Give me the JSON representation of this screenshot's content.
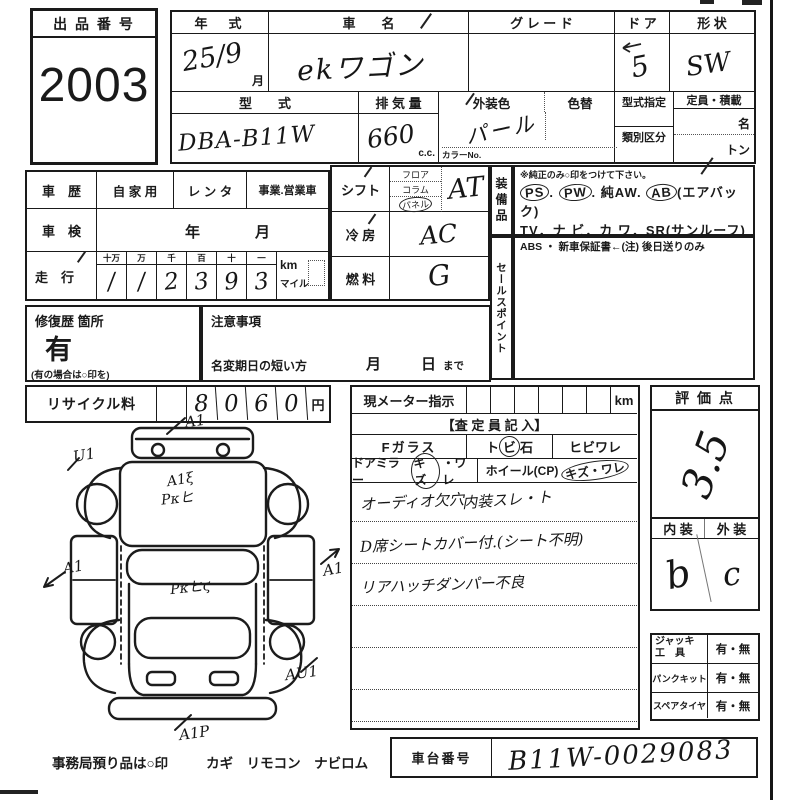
{
  "colors": {
    "ink": "#1a1a1a",
    "paper": "#ffffff"
  },
  "auction": {
    "label": "出 品 番 号",
    "number": "2003"
  },
  "vehicle": {
    "year_label": "年　式",
    "year_value": "25/9",
    "month_suffix": "月",
    "name_label": "車　　名",
    "name_value": "ekワゴン",
    "grade_label": "グ レ ー ド",
    "grade_value": "",
    "door_label": "ド ア",
    "door_value": "5",
    "shape_label": "形 状",
    "shape_value": "SW",
    "model_label": "型　　式",
    "model_value": "DBA-B11W",
    "disp_label": "排 気 量",
    "disp_value": "660",
    "disp_unit": "c.c.",
    "color_label": "外装色",
    "color_value": "パール",
    "color_change_label": "色替",
    "color_no_label": "カラーNo.",
    "type_desig_label": "型式指定",
    "class_label": "類別区分",
    "capacity_label": "定員・積載",
    "capacity_persons": "名",
    "capacity_tons": "トン"
  },
  "history": {
    "label": "車　歴",
    "private_label": "自 家 用",
    "rental_label": "レ ン タ",
    "business_label": "事業.営業車",
    "inspection_label": "車　検",
    "inspection_year": "年",
    "inspection_month": "月",
    "mileage_label": "走　行",
    "digit_headers": [
      "十万",
      "万",
      "千",
      "百",
      "十",
      "一"
    ],
    "digits": [
      "/",
      "/",
      "2",
      "3",
      "9",
      "3"
    ],
    "unit_km": "km",
    "unit_mile": "マイル"
  },
  "controls": {
    "shift_label": "シフト",
    "shift_opt1": "フロア",
    "shift_opt2": "コラム",
    "shift_opt3": "パネル",
    "shift_value": "AT",
    "ac_label": "冷 房",
    "ac_value": "AC",
    "fuel_label": "燃 料",
    "fuel_value": "G"
  },
  "equipment": {
    "vertical_label": "装備品",
    "note": "※純正のみ○印をつけて下さい。",
    "ps": "PS",
    "pw": "PW",
    "sep": ".",
    "aw": "純AW.",
    "ab": "AB",
    "ab_paren": "(エアバック)",
    "line2": "TV．ナ ビ．カ ワ．SR(サンルーフ)",
    "line3": "ABS ・ 新車保証書←(注) 後日送りのみ"
  },
  "sales_point": {
    "vertical_label": "セールスポイント"
  },
  "repair": {
    "label": "修復歴 箇所",
    "value": "有",
    "note": "(有の場合は○印を)"
  },
  "caution": {
    "label": "注意事項",
    "name_change_label": "名変期日の短い方",
    "month": "月",
    "day": "日",
    "until": "まで"
  },
  "recycle": {
    "label": "リサイクル料",
    "digits": [
      "8",
      "0",
      "6",
      "0"
    ],
    "unit": "円"
  },
  "meter": {
    "label": "現メーター指示",
    "unit": "km",
    "assessor_header": "【査 定 員 記 入】",
    "fglass_label": "Fガラス",
    "fglass_opt1_pre": "ト",
    "fglass_opt1_circ": "ビ",
    "fglass_opt1_post": "石",
    "fglass_opt2": "ヒビワレ",
    "mirror_label": "ドアミラー",
    "mirror_circ": "キズ",
    "mirror_post": "・ワレ",
    "wheel_label": "ホイール(CP)",
    "wheel_circ": "キズ・ワレ",
    "note1a": "オーディオ欠穴",
    "note1b": "内装スレ・ト",
    "note2": "D席シートカバー付.(シート不明)",
    "note3": "リアハッチダンパー不良"
  },
  "evaluation": {
    "label": "評 価 点",
    "score": "3.5",
    "interior_label": "内 装",
    "exterior_label": "外 装",
    "interior_value": "b",
    "exterior_value": "c"
  },
  "tools": {
    "rows": [
      {
        "label_top": "ジャッキ",
        "label_bottom": "工　具",
        "value": "有・無"
      },
      {
        "label": "パンクキット",
        "value": "有・無"
      },
      {
        "label": "スペアタイヤ",
        "value": "有・無"
      }
    ]
  },
  "chassis": {
    "label": "車台番号",
    "value": "B11W-0029083"
  },
  "office_note": {
    "lead": "事務局預り品は○印",
    "items": "カギ　リモコン　ナビロム"
  },
  "diagram": {
    "codes": [
      "A1",
      "U1",
      "A1ξ",
      "Pκヒ",
      "A1",
      "Pκヒϛ",
      "A1",
      "AU1",
      "A1P"
    ]
  }
}
